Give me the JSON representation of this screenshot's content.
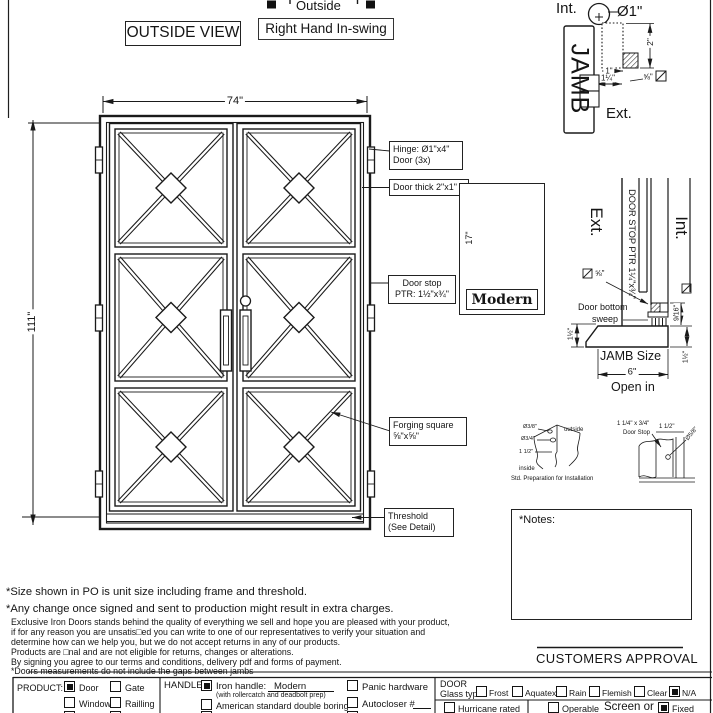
{
  "header": {
    "outside_view": "OUTSIDE VIEW",
    "outside": "Outside",
    "swing_label": "Right Hand In-swing"
  },
  "door": {
    "width": "74\"",
    "height": "111\""
  },
  "callouts": {
    "hinge_1": "Hinge: Ø1\"x4\"",
    "hinge_2": "Door (3x)",
    "thick": "Door thick 2\"x1\"",
    "stop_1": "Door stop",
    "stop_2": "PTR: 1½\"x¾\"",
    "forging_1": "Forging square",
    "forging_2": "⅝\"x⅝\"",
    "threshold_1": "Threshold",
    "threshold_2": "(See Detail)"
  },
  "hinge_detail": {
    "int": "Int.",
    "ext": "Ext.",
    "jamb": "JAMB",
    "dia": "Ø1\"",
    "dim_2": "2\"",
    "dim_1": "1\"",
    "dim_125": "1¼\"",
    "dim_58": "⅝\""
  },
  "handle_detail": {
    "dim": "17\"",
    "name": "Modern"
  },
  "jamb_section": {
    "ext": "Ext.",
    "int": "Int.",
    "stop": "DOOR STOP PTR 1¼\"x¾\"",
    "dim_58": "⅝\"",
    "sweep_1": "Door bottom",
    "sweep_2": "sweep",
    "dim_left": "1½\"",
    "dim_916": "9/16\"",
    "dim_right": "1½\"",
    "size_label": "JAMB Size",
    "size_value": "6\"",
    "open_in": "Open in"
  },
  "prep_detail": {
    "dia_38": "Ø3/8\"",
    "dia_34": "Ø3/4\"",
    "dim_112": "1 1/2\"",
    "outside": "outside",
    "inside": "inside",
    "caption": "Std. Preparation for Installation"
  },
  "stop_detail": {
    "line1": "1 1/4\" x 3/4\"",
    "line2": "Door Stop",
    "dim_112": "1 1/2\"",
    "dia_58": "Ø5/8\""
  },
  "notes_label": "*Notes:",
  "approval": "CUSTOMERS APPROVAL",
  "disclaimers": {
    "big_1": "*Size shown in PO is unit size including frame and threshold.",
    "big_2": "*Any change once signed and sent to production might result in extra charges.",
    "small": [
      "Exclusive Iron Doors stands behind the quality of everything we sell and hope you are pleased with your product,",
      "if for any reason you are unsatis□ed you can write to one of our representatives to verify your situation and",
      "determine how can we help you, but we do not accept returns in any of our products.",
      "Products are □nal and are not eligible for returns, changes or alterations.",
      "By signing you agree to our terms and conditions, delivery pdf and forms of payment.",
      "*Doors measurements do not include the gaps between jambs"
    ]
  },
  "form": {
    "product": {
      "label": "PRODUCT:",
      "options": [
        {
          "label": "Door",
          "checked": true
        },
        {
          "label": "Gate",
          "checked": false
        },
        {
          "label": "Window",
          "checked": false
        },
        {
          "label": "Railling",
          "checked": false
        }
      ]
    },
    "handle": {
      "label": "HANDLE",
      "iron": {
        "label": "Iron handle:",
        "value": "Modern",
        "checked": true
      },
      "iron_sub": "(with rollercatch and deadbolt prep)",
      "boring": {
        "label": "American standard double boring",
        "checked": false
      },
      "panic": {
        "label": "Panic hardware",
        "checked": false
      },
      "autocloser": {
        "label": "Autocloser #",
        "checked": false
      }
    },
    "door_section": {
      "label": "DOOR",
      "glass_label": "Glass type",
      "glass": [
        {
          "label": "Frost",
          "checked": false
        },
        {
          "label": "Aquatex",
          "checked": false
        },
        {
          "label": "Rain",
          "checked": false
        },
        {
          "label": "Flemish",
          "checked": false
        },
        {
          "label": "Clear",
          "checked": false
        },
        {
          "label": "N/A",
          "checked": true
        }
      ],
      "hurricane": {
        "label": "Hurricane rated",
        "checked": false
      },
      "operable": {
        "label": "Operable",
        "checked": false
      },
      "screen_or": "Screen or",
      "fixed": {
        "label": "Fixed",
        "checked": true
      }
    }
  }
}
